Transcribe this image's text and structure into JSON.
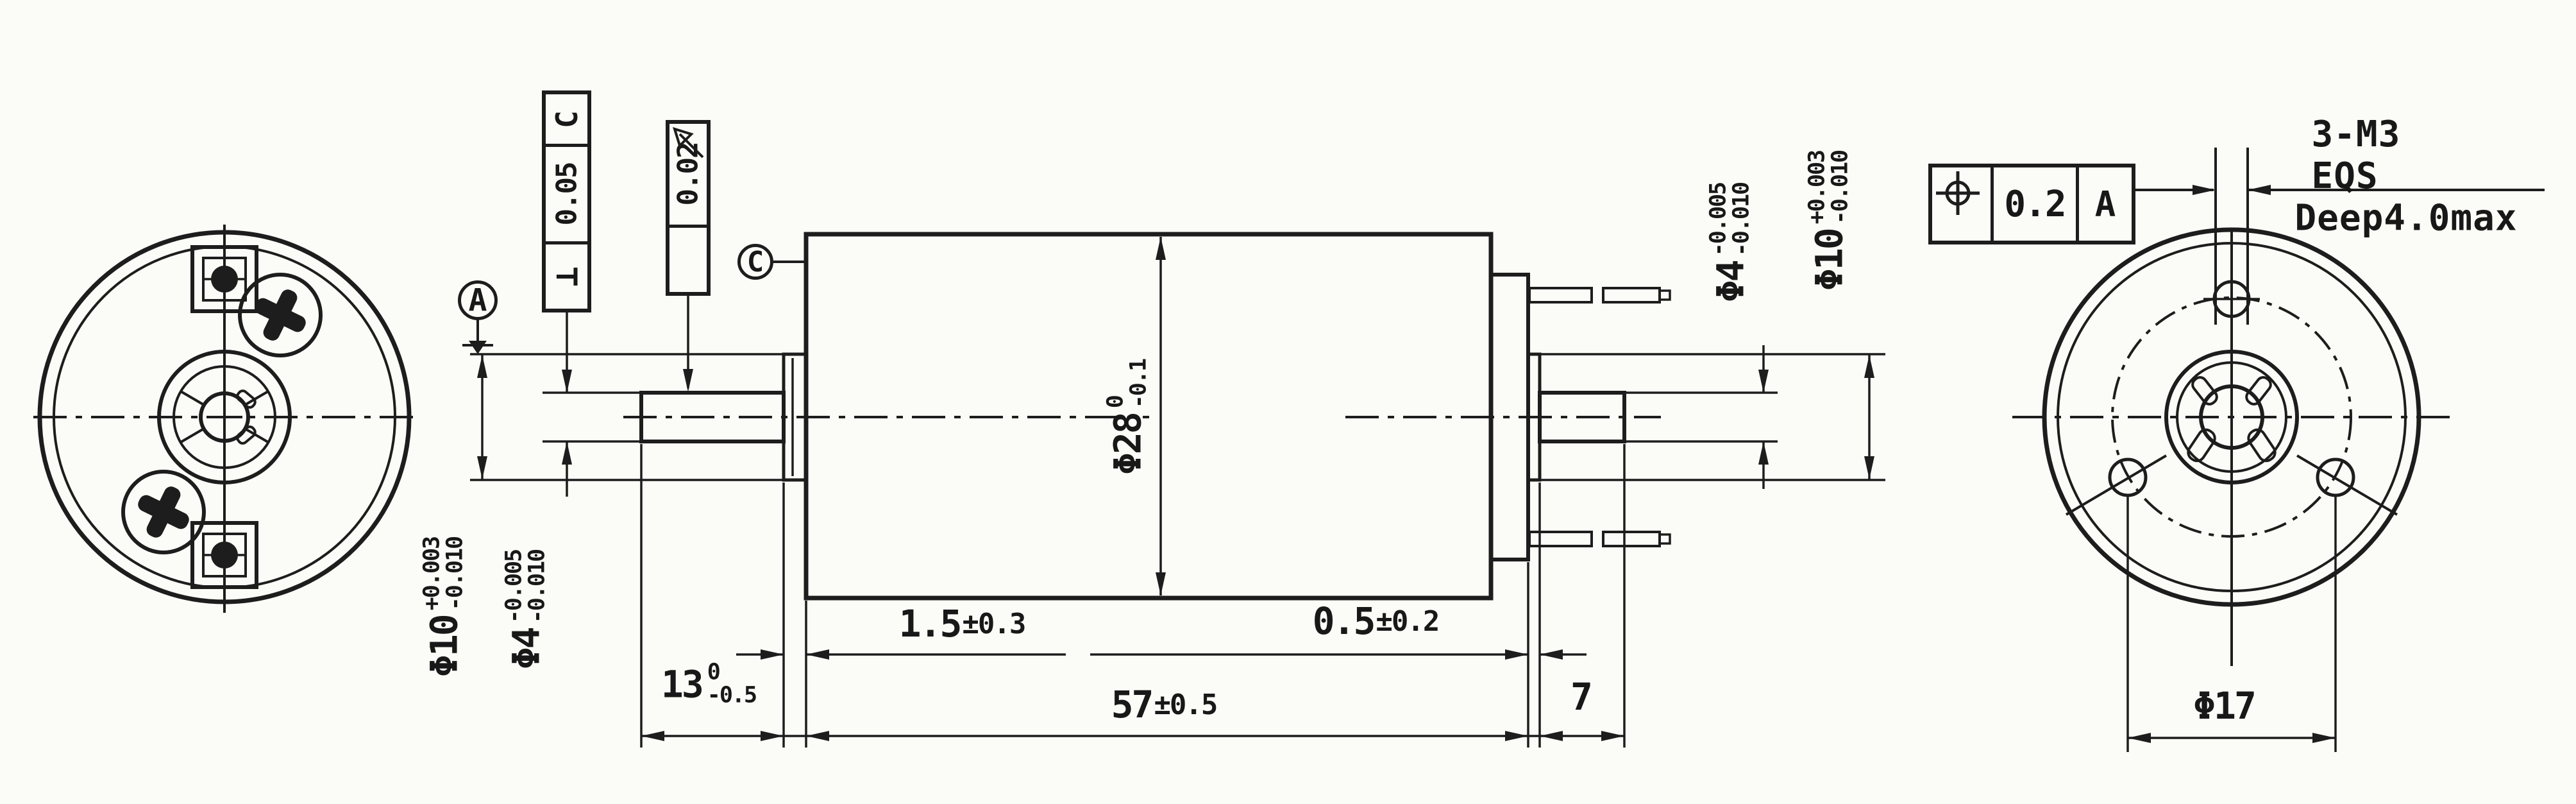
{
  "drawing": {
    "description": "Motor outline engineering drawing, three views",
    "line_color": "#1d1d1d",
    "paper_color": "#fbfbf7"
  },
  "tolerances": {
    "perpendicularity": {
      "symbol": "⊥",
      "value": "0.05",
      "datum": "C"
    },
    "runout": {
      "value": "0.02",
      "symbol_name": "runout-arrow"
    },
    "position": {
      "value": "0.2",
      "datum": "A",
      "symbol_name": "position-crosshair"
    }
  },
  "datums": {
    "a": "A",
    "c": "C"
  },
  "dimensions": {
    "body_diameter": {
      "prefix": "Φ28",
      "upper": "0",
      "lower": "-0.1"
    },
    "front_boss_diameter": {
      "prefix": "Φ10",
      "upper": "+0.003",
      "lower": "-0.010"
    },
    "front_shaft_diameter": {
      "prefix": "Φ4",
      "upper": "-0.005",
      "lower": "-0.010"
    },
    "rear_shaft_diameter": {
      "prefix": "Φ4",
      "upper": "-0.005",
      "lower": "-0.010"
    },
    "rear_boss_diameter": {
      "prefix": "Φ10",
      "upper": "+0.003",
      "lower": "-0.010"
    },
    "shaft_length": {
      "value": "13",
      "upper": "0",
      "lower": "-0.5"
    },
    "front_boss_protrusion": {
      "value": "1.5",
      "tolerance": "±0.3"
    },
    "body_length": {
      "value": "57",
      "tolerance": "±0.5"
    },
    "rear_boss_protrusion": {
      "value": "0.5",
      "tolerance": "±0.2"
    },
    "rear_shaft_length": {
      "value": "7"
    },
    "bolt_circle_diameter": {
      "value": "Φ17"
    }
  },
  "notes": {
    "thread_callout": "3-M3 EQS",
    "thread_depth": "Deep4.0max"
  },
  "icons": {
    "runout_arrow": "arrow pointing up-left at 45 degrees",
    "position_symbol": "circle with crosshair"
  }
}
